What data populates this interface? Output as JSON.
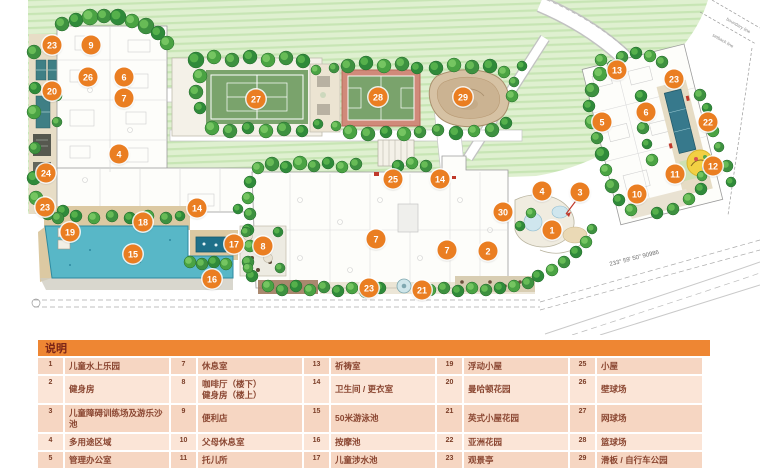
{
  "legend": {
    "title": "说明",
    "columns": [
      {
        "items": [
          {
            "num": "1",
            "label": "儿童水上乐园"
          },
          {
            "num": "2",
            "label": "健身房"
          },
          {
            "num": "3",
            "label": "儿童障碍训练场及游乐沙池"
          },
          {
            "num": "4",
            "label": "多用途区域"
          },
          {
            "num": "5",
            "label": "管理办公室"
          },
          {
            "num": "6",
            "label": "阅读区"
          }
        ]
      },
      {
        "items": [
          {
            "num": "7",
            "label": "休息室"
          },
          {
            "num": "8",
            "label": "咖啡厅（楼下）\n健身房（楼上）"
          },
          {
            "num": "9",
            "label": "便利店"
          },
          {
            "num": "10",
            "label": "父母休息室"
          },
          {
            "num": "11",
            "label": "托儿所"
          },
          {
            "num": "12",
            "label": "游乐场花园"
          }
        ]
      },
      {
        "items": [
          {
            "num": "13",
            "label": "祈祷室"
          },
          {
            "num": "14",
            "label": "卫生间 / 更衣室"
          },
          {
            "num": "15",
            "label": "50米游泳池"
          },
          {
            "num": "16",
            "label": "按摩池"
          },
          {
            "num": "17",
            "label": "儿童涉水池"
          },
          {
            "num": "18",
            "label": "游泳池甲板"
          }
        ]
      },
      {
        "items": [
          {
            "num": "19",
            "label": "浮动小屋"
          },
          {
            "num": "20",
            "label": "曼哈顿花园"
          },
          {
            "num": "21",
            "label": "英式小屋花园"
          },
          {
            "num": "22",
            "label": "亚洲花园"
          },
          {
            "num": "23",
            "label": "观景亭"
          },
          {
            "num": "24",
            "label": "阳台休息座"
          }
        ]
      },
      {
        "items": [
          {
            "num": "25",
            "label": "小屋"
          },
          {
            "num": "26",
            "label": "壁球场"
          },
          {
            "num": "27",
            "label": "网球场"
          },
          {
            "num": "28",
            "label": "篮球场"
          },
          {
            "num": "29",
            "label": "滑板 / 自行车公园"
          },
          {
            "num": "30",
            "label": "高尔夫球场"
          }
        ]
      }
    ]
  },
  "annotations": {
    "bearing": "233° 59' 50\"  90986",
    "boundary_label": "boundary line",
    "setback_label": "setback line"
  },
  "colors": {
    "marker_orange": "#ea7e22",
    "legend_header": "#ee8633",
    "pool_teal": "#58b7c7",
    "lawn_green": "#dff0d0",
    "court_green": "#7aa36c"
  },
  "map": {
    "markers": [
      {
        "n": 1,
        "x": 552,
        "y": 230
      },
      {
        "n": 2,
        "x": 488,
        "y": 251
      },
      {
        "n": 3,
        "x": 580,
        "y": 192
      },
      {
        "n": 4,
        "x": 119,
        "y": 154
      },
      {
        "n": 4,
        "x": 542,
        "y": 191
      },
      {
        "n": 5,
        "x": 602,
        "y": 122
      },
      {
        "n": 6,
        "x": 124,
        "y": 77
      },
      {
        "n": 6,
        "x": 646,
        "y": 112
      },
      {
        "n": 7,
        "x": 124,
        "y": 98
      },
      {
        "n": 7,
        "x": 376,
        "y": 239
      },
      {
        "n": 7,
        "x": 447,
        "y": 250
      },
      {
        "n": 8,
        "x": 263,
        "y": 246
      },
      {
        "n": 9,
        "x": 91,
        "y": 45
      },
      {
        "n": 10,
        "x": 637,
        "y": 194
      },
      {
        "n": 11,
        "x": 675,
        "y": 174
      },
      {
        "n": 12,
        "x": 713,
        "y": 166
      },
      {
        "n": 13,
        "x": 617,
        "y": 70
      },
      {
        "n": 14,
        "x": 197,
        "y": 208
      },
      {
        "n": 14,
        "x": 440,
        "y": 179
      },
      {
        "n": 15,
        "x": 133,
        "y": 254
      },
      {
        "n": 16,
        "x": 212,
        "y": 279
      },
      {
        "n": 17,
        "x": 234,
        "y": 244
      },
      {
        "n": 18,
        "x": 143,
        "y": 222
      },
      {
        "n": 19,
        "x": 70,
        "y": 232
      },
      {
        "n": 20,
        "x": 52,
        "y": 91
      },
      {
        "n": 21,
        "x": 422,
        "y": 290
      },
      {
        "n": 22,
        "x": 708,
        "y": 122
      },
      {
        "n": 23,
        "x": 52,
        "y": 45
      },
      {
        "n": 23,
        "x": 45,
        "y": 207
      },
      {
        "n": 23,
        "x": 369,
        "y": 288
      },
      {
        "n": 23,
        "x": 674,
        "y": 79
      },
      {
        "n": 24,
        "x": 46,
        "y": 173
      },
      {
        "n": 25,
        "x": 393,
        "y": 179
      },
      {
        "n": 26,
        "x": 88,
        "y": 77
      },
      {
        "n": 27,
        "x": 256,
        "y": 99
      },
      {
        "n": 28,
        "x": 378,
        "y": 97
      },
      {
        "n": 29,
        "x": 463,
        "y": 97
      },
      {
        "n": 30,
        "x": 503,
        "y": 212
      }
    ],
    "trees": [
      [
        62,
        24,
        7
      ],
      [
        76,
        20,
        7
      ],
      [
        90,
        17,
        8
      ],
      [
        104,
        16,
        7
      ],
      [
        118,
        17,
        8
      ],
      [
        132,
        21,
        7
      ],
      [
        146,
        26,
        8
      ],
      [
        158,
        33,
        7
      ],
      [
        167,
        43,
        7
      ],
      [
        34,
        52,
        7
      ],
      [
        35,
        88,
        6
      ],
      [
        34,
        112,
        7
      ],
      [
        35,
        148,
        6
      ],
      [
        34,
        178,
        7
      ],
      [
        36,
        198,
        7
      ],
      [
        48,
        213,
        7
      ],
      [
        63,
        211,
        6
      ],
      [
        57,
        96,
        5
      ],
      [
        57,
        122,
        5
      ],
      [
        196,
        60,
        8
      ],
      [
        214,
        57,
        7
      ],
      [
        232,
        60,
        7
      ],
      [
        250,
        57,
        7
      ],
      [
        268,
        60,
        7
      ],
      [
        286,
        58,
        7
      ],
      [
        303,
        61,
        7
      ],
      [
        200,
        76,
        7
      ],
      [
        196,
        92,
        7
      ],
      [
        200,
        108,
        6
      ],
      [
        212,
        128,
        7
      ],
      [
        230,
        131,
        7
      ],
      [
        248,
        128,
        6
      ],
      [
        266,
        131,
        7
      ],
      [
        284,
        129,
        7
      ],
      [
        302,
        131,
        6
      ],
      [
        316,
        70,
        5
      ],
      [
        334,
        68,
        5
      ],
      [
        318,
        124,
        5
      ],
      [
        336,
        126,
        5
      ],
      [
        348,
        66,
        7
      ],
      [
        366,
        63,
        7
      ],
      [
        384,
        66,
        7
      ],
      [
        402,
        64,
        7
      ],
      [
        417,
        68,
        6
      ],
      [
        350,
        132,
        7
      ],
      [
        368,
        134,
        7
      ],
      [
        386,
        132,
        6
      ],
      [
        404,
        134,
        7
      ],
      [
        420,
        132,
        6
      ],
      [
        436,
        68,
        7
      ],
      [
        454,
        65,
        7
      ],
      [
        472,
        67,
        7
      ],
      [
        490,
        66,
        7
      ],
      [
        504,
        72,
        6
      ],
      [
        438,
        130,
        6
      ],
      [
        456,
        133,
        7
      ],
      [
        474,
        131,
        6
      ],
      [
        492,
        130,
        7
      ],
      [
        506,
        123,
        6
      ],
      [
        512,
        96,
        6
      ],
      [
        514,
        82,
        5
      ],
      [
        522,
        66,
        5
      ],
      [
        600,
        74,
        7
      ],
      [
        592,
        90,
        7
      ],
      [
        589,
        106,
        6
      ],
      [
        592,
        122,
        7
      ],
      [
        597,
        138,
        6
      ],
      [
        602,
        154,
        7
      ],
      [
        606,
        170,
        6
      ],
      [
        612,
        186,
        7
      ],
      [
        619,
        200,
        6
      ],
      [
        631,
        210,
        6
      ],
      [
        622,
        57,
        6
      ],
      [
        636,
        53,
        6
      ],
      [
        650,
        56,
        6
      ],
      [
        662,
        62,
        6
      ],
      [
        641,
        96,
        6
      ],
      [
        644,
        112,
        5
      ],
      [
        643,
        128,
        6
      ],
      [
        647,
        144,
        5
      ],
      [
        652,
        160,
        6
      ],
      [
        700,
        95,
        6
      ],
      [
        707,
        108,
        5
      ],
      [
        713,
        131,
        6
      ],
      [
        719,
        147,
        5
      ],
      [
        701,
        189,
        6
      ],
      [
        689,
        199,
        6
      ],
      [
        673,
        209,
        6
      ],
      [
        657,
        213,
        6
      ],
      [
        702,
        176,
        5
      ],
      [
        727,
        166,
        6
      ],
      [
        731,
        182,
        5
      ],
      [
        258,
        168,
        6
      ],
      [
        272,
        164,
        7
      ],
      [
        286,
        167,
        6
      ],
      [
        300,
        163,
        7
      ],
      [
        314,
        166,
        6
      ],
      [
        328,
        163,
        6
      ],
      [
        342,
        167,
        6
      ],
      [
        356,
        164,
        6
      ],
      [
        398,
        166,
        6
      ],
      [
        412,
        163,
        6
      ],
      [
        426,
        166,
        6
      ],
      [
        250,
        182,
        6
      ],
      [
        248,
        198,
        6
      ],
      [
        250,
        214,
        6
      ],
      [
        248,
        230,
        6
      ],
      [
        250,
        246,
        6
      ],
      [
        248,
        262,
        6
      ],
      [
        252,
        276,
        6
      ],
      [
        268,
        286,
        6
      ],
      [
        282,
        290,
        6
      ],
      [
        296,
        286,
        6
      ],
      [
        310,
        290,
        6
      ],
      [
        324,
        287,
        6
      ],
      [
        338,
        291,
        6
      ],
      [
        352,
        288,
        6
      ],
      [
        366,
        291,
        7
      ],
      [
        380,
        288,
        6
      ],
      [
        430,
        290,
        6
      ],
      [
        444,
        288,
        6
      ],
      [
        458,
        291,
        6
      ],
      [
        472,
        288,
        6
      ],
      [
        486,
        290,
        6
      ],
      [
        500,
        288,
        6
      ],
      [
        514,
        286,
        6
      ],
      [
        528,
        283,
        6
      ],
      [
        538,
        276,
        6
      ],
      [
        552,
        270,
        6
      ],
      [
        564,
        262,
        6
      ],
      [
        576,
        252,
        6
      ],
      [
        586,
        242,
        6
      ],
      [
        592,
        229,
        5
      ],
      [
        520,
        226,
        5
      ],
      [
        531,
        213,
        5
      ],
      [
        58,
        218,
        6
      ],
      [
        76,
        216,
        6
      ],
      [
        94,
        218,
        6
      ],
      [
        112,
        216,
        6
      ],
      [
        130,
        218,
        6
      ],
      [
        148,
        216,
        6
      ],
      [
        166,
        218,
        6
      ],
      [
        180,
        216,
        5
      ],
      [
        190,
        262,
        6
      ],
      [
        202,
        264,
        6
      ],
      [
        214,
        262,
        6
      ],
      [
        226,
        264,
        6
      ],
      [
        246,
        232,
        5
      ],
      [
        278,
        232,
        5
      ],
      [
        248,
        268,
        5
      ],
      [
        280,
        268,
        5
      ],
      [
        238,
        209,
        5
      ],
      [
        601,
        60,
        6
      ],
      [
        613,
        66,
        6
      ]
    ]
  }
}
